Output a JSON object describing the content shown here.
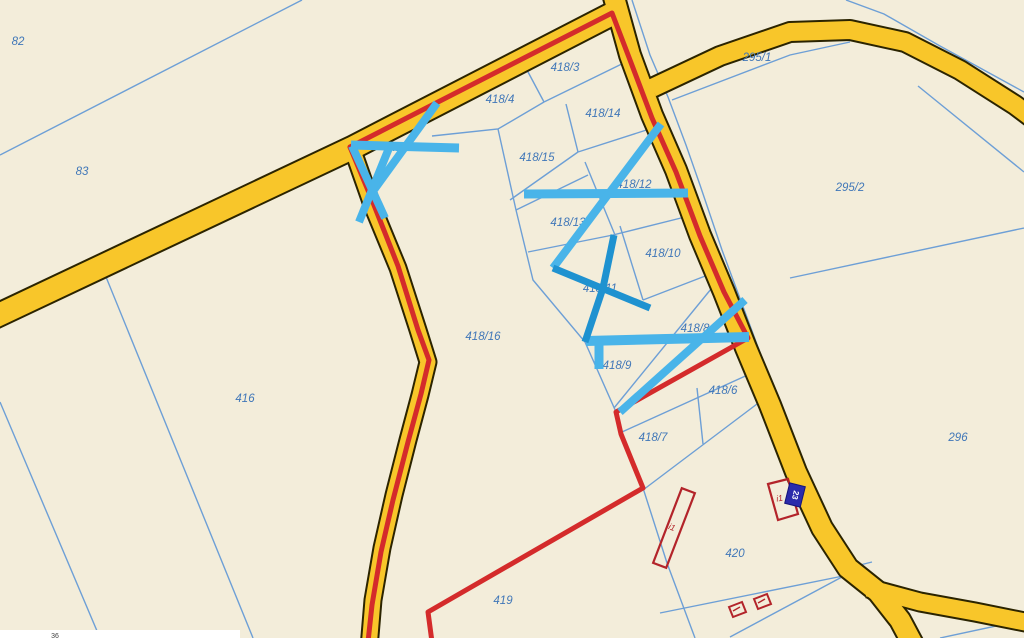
{
  "map": {
    "background_color": "#f3edda",
    "road_fill": "#f8c62a",
    "road_casing": "#2b2400",
    "parcel_line_color": "#6d9fd6",
    "label_color": "#4077b8",
    "selection_color": "#d42b2b",
    "hatch_light_color": "#49b4e9",
    "hatch_dark_color": "#1f92d0",
    "building_color": "#b3242a",
    "marker": {
      "fill": "#2b2bab",
      "text": "23",
      "text_color": "#ffffff"
    },
    "partial_bottom_label": "36",
    "parcel_labels": [
      {
        "id": "82",
        "x": 18,
        "y": 41
      },
      {
        "id": "83",
        "x": 82,
        "y": 171
      },
      {
        "id": "416",
        "x": 245,
        "y": 398
      },
      {
        "id": "418/3",
        "x": 565,
        "y": 67
      },
      {
        "id": "418/4",
        "x": 500,
        "y": 99
      },
      {
        "id": "418/5",
        "x": 404,
        "y": 147
      },
      {
        "id": "418/14",
        "x": 603,
        "y": 113
      },
      {
        "id": "418/15",
        "x": 537,
        "y": 157
      },
      {
        "id": "418/12",
        "x": 634,
        "y": 184
      },
      {
        "id": "418/13",
        "x": 568,
        "y": 222
      },
      {
        "id": "418/10",
        "x": 663,
        "y": 253
      },
      {
        "id": "418/11",
        "x": 600,
        "y": 288
      },
      {
        "id": "418/16",
        "x": 483,
        "y": 336
      },
      {
        "id": "418/8",
        "x": 695,
        "y": 328
      },
      {
        "id": "418/9",
        "x": 617,
        "y": 365
      },
      {
        "id": "418/6",
        "x": 723,
        "y": 390
      },
      {
        "id": "418/7",
        "x": 653,
        "y": 437
      },
      {
        "id": "419",
        "x": 503,
        "y": 600
      },
      {
        "id": "420",
        "x": 735,
        "y": 553
      },
      {
        "id": "295/1",
        "x": 757,
        "y": 57
      },
      {
        "id": "295/2",
        "x": 850,
        "y": 187
      },
      {
        "id": "296",
        "x": 958,
        "y": 437
      }
    ],
    "building_annotations": [
      {
        "text": "i1",
        "x": 671,
        "y": 530,
        "rotate": 20
      },
      {
        "text": "i1",
        "x": 780,
        "y": 501,
        "rotate": -10
      }
    ]
  }
}
